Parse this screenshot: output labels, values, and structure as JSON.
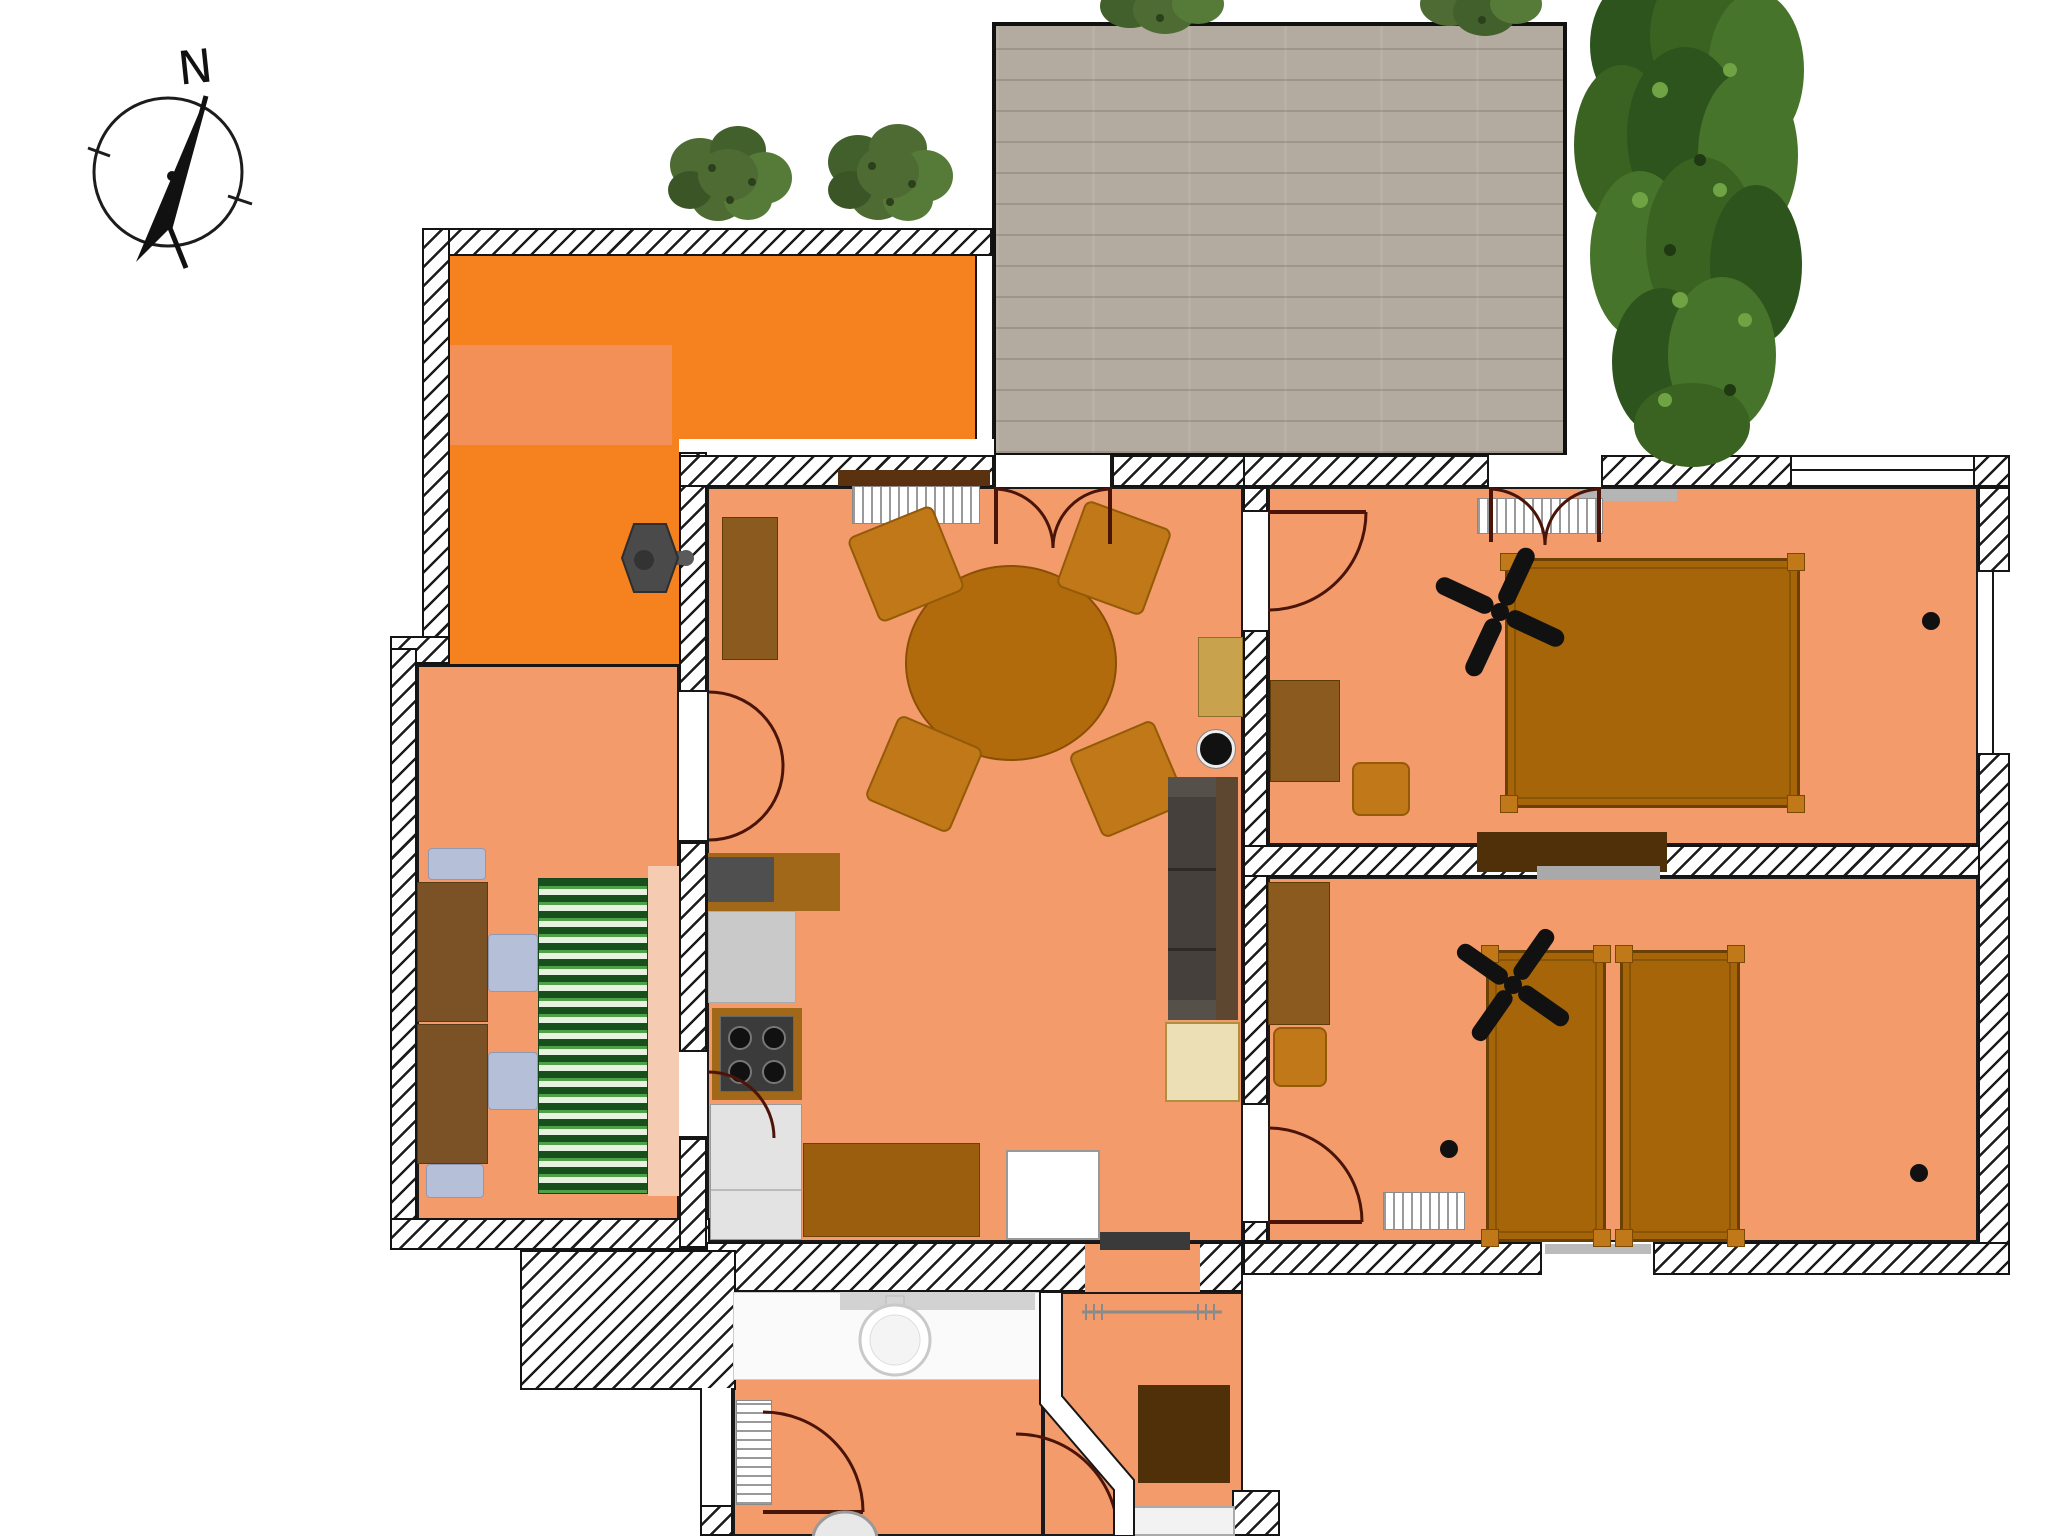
{
  "compass": {
    "label": "N"
  },
  "palette": {
    "floor_salmon": "#F49B6C",
    "floor_orange": "#F5821E",
    "floor_orange_light": "#F29058",
    "wall_line": "#161616",
    "patio_gray": "#B3AB9F",
    "bush_green": "#4E6B33",
    "tree_green": "#3A6322",
    "wood_mid": "#A56508",
    "wood_dark": "#4F3008",
    "wood_light": "#C9A24E",
    "chair_wood": "#C07818",
    "sofa_dark": "#45403B",
    "cushion_blue": "#B6BFD8",
    "mat_green": "#17501C",
    "door_arc": "#4A1408",
    "radiator_line": "#9A9A9A",
    "sideboard_beige": "#EDDFB5"
  }
}
